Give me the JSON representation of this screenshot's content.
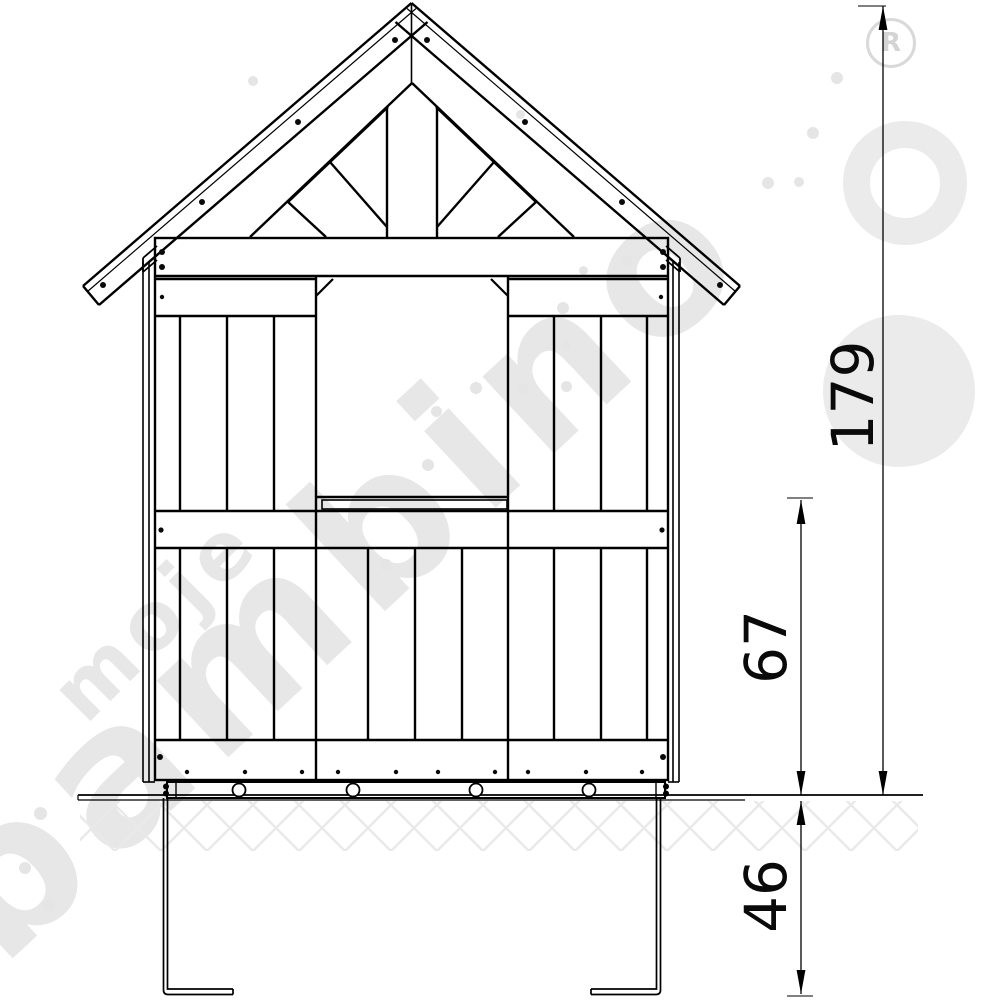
{
  "drawing": {
    "subject": "wooden playhouse front elevation with ground anchors",
    "style": "black line technical drawing on white",
    "parts": [
      "gable-roof",
      "gable-truss",
      "top-plate",
      "window-opening",
      "window-sill",
      "plank-cladding",
      "mid-rail",
      "bottom-rail",
      "base-skid",
      "ground-line",
      "soil-hatch",
      "ground-anchors"
    ]
  },
  "dimensions": {
    "total_height": {
      "value": "179",
      "orientation": "vertical",
      "measures": "ground line to roof peak"
    },
    "sill_height": {
      "value": "67",
      "orientation": "vertical",
      "measures": "ground line to window sill rail"
    },
    "anchor_depth": {
      "value": "46",
      "orientation": "vertical",
      "measures": "ground line to bottom of anchors"
    }
  },
  "watermark": {
    "word1": "moje",
    "word2": "bambino",
    "registered_mark": "R"
  },
  "colors": {
    "line": "#000000",
    "background": "#ffffff",
    "watermark_gray": "#e7e7e7",
    "hatch_gray": "#e9e9e9"
  }
}
